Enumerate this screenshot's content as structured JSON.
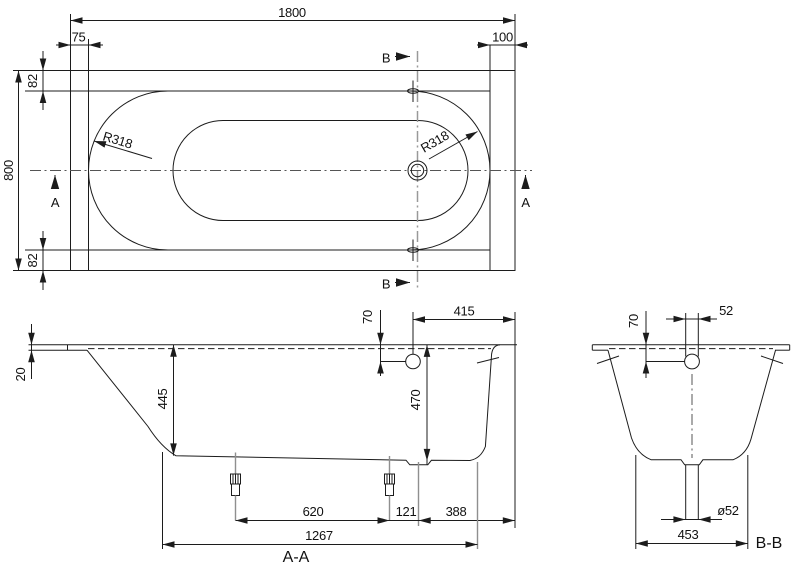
{
  "plan": {
    "dim_length": "1800",
    "dim_width": "800",
    "dim_left_inset": "75",
    "dim_right_inset": "100",
    "dim_top_inset": "82",
    "dim_bottom_inset": "82",
    "radius": "R318",
    "section_a": "A",
    "section_b": "B"
  },
  "aa": {
    "label": "A-A",
    "dim_rim_thickness": "20",
    "dim_depth_end": "445",
    "dim_overflow_drop": "70",
    "dim_overflow_to_end": "415",
    "dim_depth_drain": "470",
    "dim_feet_spacing": "620",
    "dim_foot_to_drain": "121",
    "dim_drain_to_end": "388",
    "dim_base_length": "1267"
  },
  "bb": {
    "label": "B-B",
    "dim_pipe_width": "52",
    "dim_overflow_drop": "70",
    "dim_drain_diameter": "ø52",
    "dim_base_width": "453"
  }
}
